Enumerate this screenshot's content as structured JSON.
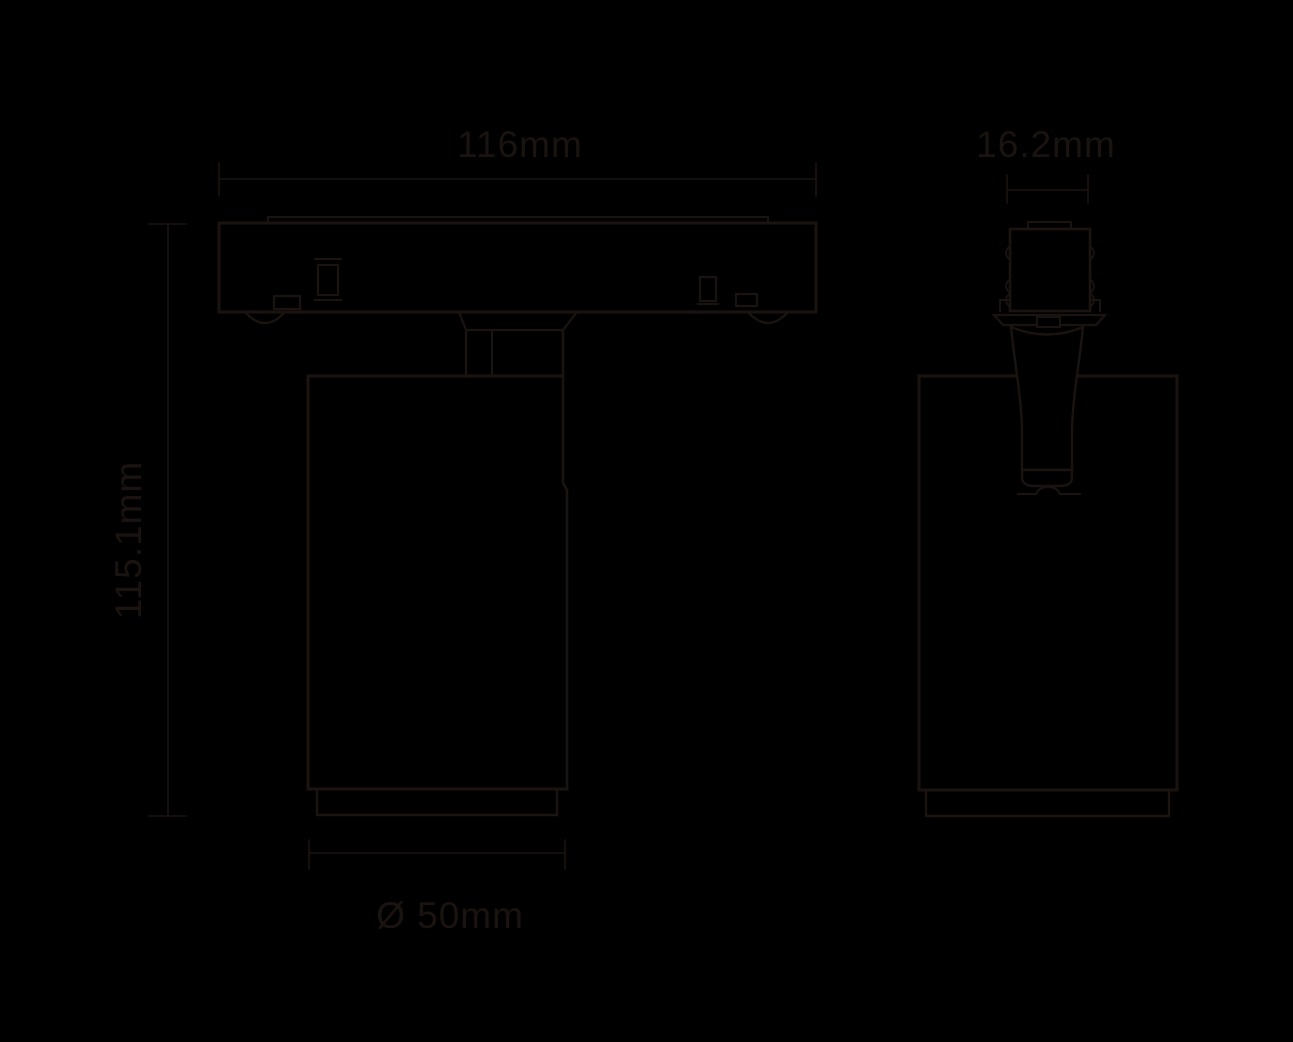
{
  "colors": {
    "background": "#000000",
    "line": "#1b1310"
  },
  "labels": {
    "track_width": "116mm",
    "adapter_depth": "16.2mm",
    "overall_height": "115.1mm",
    "head_diameter": "Ø 50mm"
  }
}
